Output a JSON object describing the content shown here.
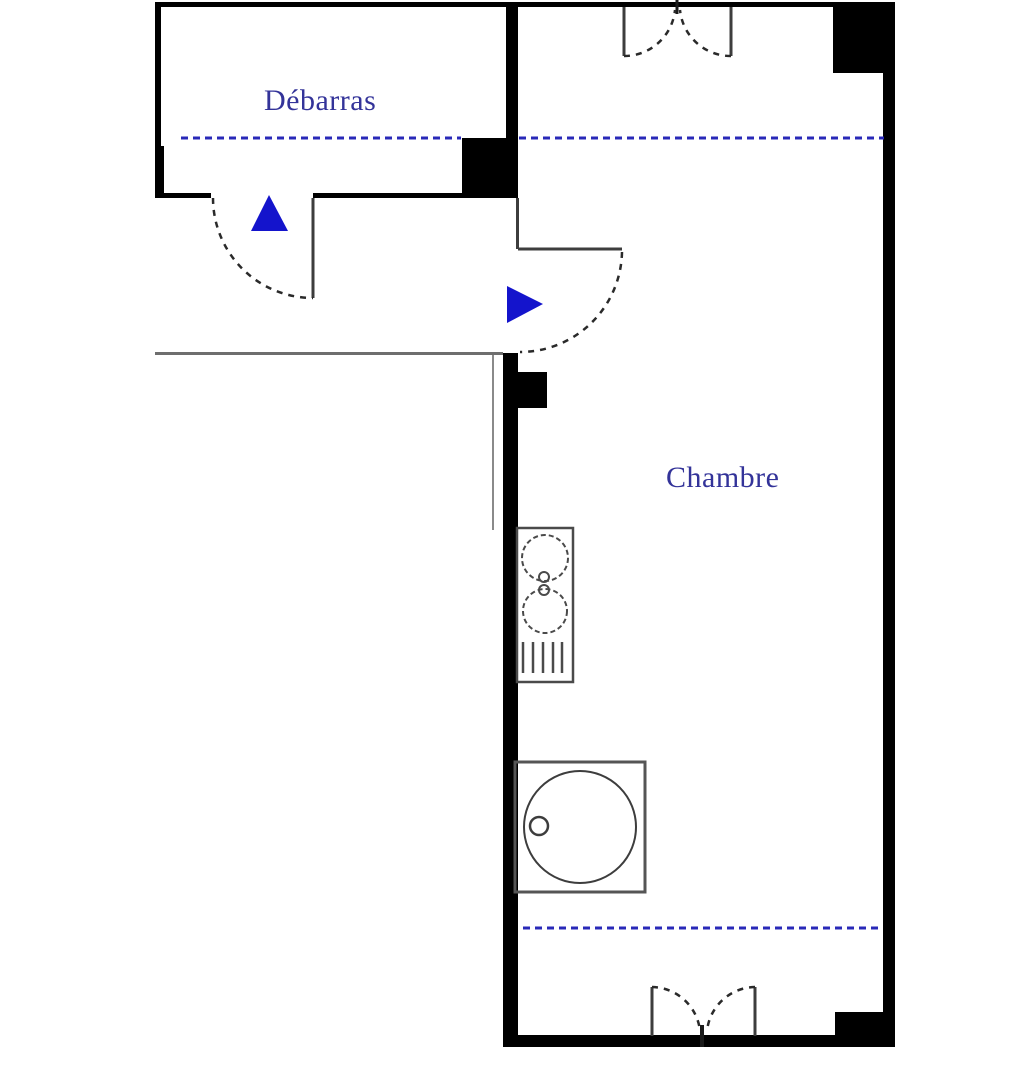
{
  "title": "Floor plan",
  "rooms": {
    "debarras": {
      "label": "Débarras"
    },
    "chambre": {
      "label": "Chambre"
    }
  },
  "colors": {
    "background": "#ffffff",
    "wall": "#000000",
    "thin_line": "#3d3d3d",
    "hall_line": "#6e6e6e",
    "fixture_stroke": "#4a4a4a",
    "dashed_guide_blue": "#2929b8",
    "arrow_blue": "#1414cc",
    "label_text": "#333399"
  },
  "symbols": {
    "up_arrow": "entry-direction-up",
    "right_arrow": "entry-direction-right",
    "door_arcs": "door-swing-dashed-arc",
    "double_window_top": "french-window-top",
    "double_window_bottom": "french-window-bottom",
    "kitchenette": "two-burner-sink-unit",
    "round_appliance": "washing-machine"
  }
}
